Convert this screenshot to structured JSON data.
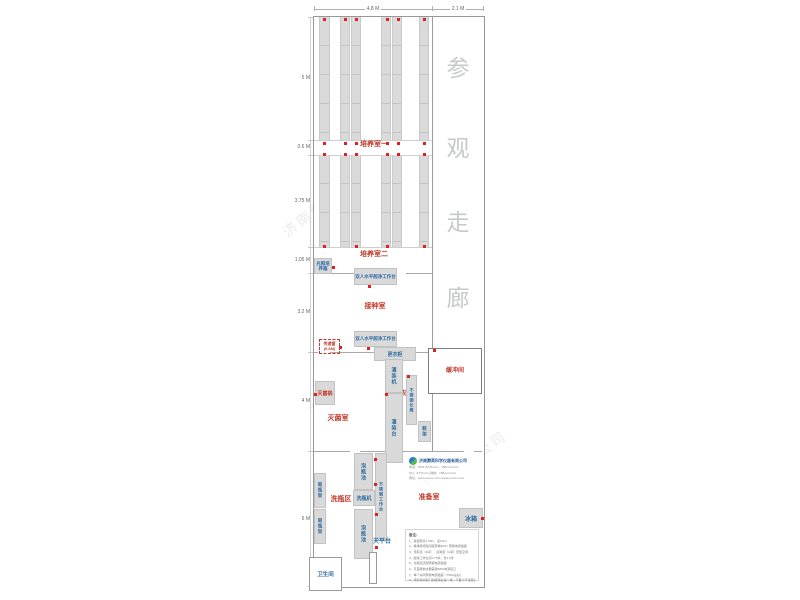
{
  "title": "组培实验室平面图",
  "corridor": {
    "label": "参观走廊",
    "chars": [
      "参",
      "观",
      "走",
      "廊"
    ]
  },
  "dimensions": {
    "top": [
      "4.8 M",
      "2.1 M"
    ],
    "left": [
      "5 M",
      "0.6 M",
      "3.75 M",
      "1.05 M",
      "3.2 M",
      "4 M",
      "6 M"
    ]
  },
  "rooms": {
    "culture1": "培养室一",
    "culture2": "培养室二",
    "inoculation": "接种室",
    "sterilization": "灭菌室",
    "changing": "更衣室",
    "buffer": "缓冲间",
    "washing": "洗瓶区",
    "preparation": "准备室"
  },
  "equipment": {
    "light_incubator": "光照培养箱",
    "clean_bench": "双人水平超净工作台",
    "transfer_window": "传递窗",
    "transfer_window_size": "(0.6M)",
    "wardrobe": "更衣柜",
    "filling_machine": "灌装机",
    "filling_table": "灌装台",
    "steel_bench": "不锈钢长凳",
    "sterilizer": "灭菌锅",
    "shoe_rack": "鞋架",
    "soak_pool": "泡瓶池",
    "steel_worktable": "不锈钢工作台",
    "bottle_washer": "洗瓶机",
    "drying_rack": "晾瓶架",
    "balance_table": "天平台",
    "toilet": "卫生间",
    "fridge": "冰箱"
  },
  "company": {
    "name": "济南腾昊科学仪器有限公司",
    "phone": "电话：0531-8779xxxx，158xxxxxxxx",
    "qq": "QQ：8747xxxx  微信：158xxxxxxxx",
    "web": "网址：www.xxxxxx.com  www.xxxxxx.com"
  },
  "notes": {
    "title": "备注：",
    "items": [
      "1、栽培架长1.25m，宽0.5m",
      "2、每排栽培架间距离墙35cm 预留电源插座",
      "3、培养室（3间）、接种室（2间）安装空调",
      "4、超净工作台高0.75米，长1.0米",
      "5、化验室货架预留电源插座",
      "6、灭菌锅热水器需用380v电源接口",
      "7、每个房间预留电源插座（750w左右）",
      "8、培养架间和门的距离在第一排，不要小于走廊宽度"
    ]
  },
  "watermark": {
    "text": "济南腾昊科学仪器有限公司"
  },
  "colors": {
    "room_label": "#c0392b",
    "equipment_label": "#2e6da4",
    "corridor_text": "#c7c9c9",
    "outlet_dot": "#e02020",
    "rack_fill": "#dadada"
  }
}
